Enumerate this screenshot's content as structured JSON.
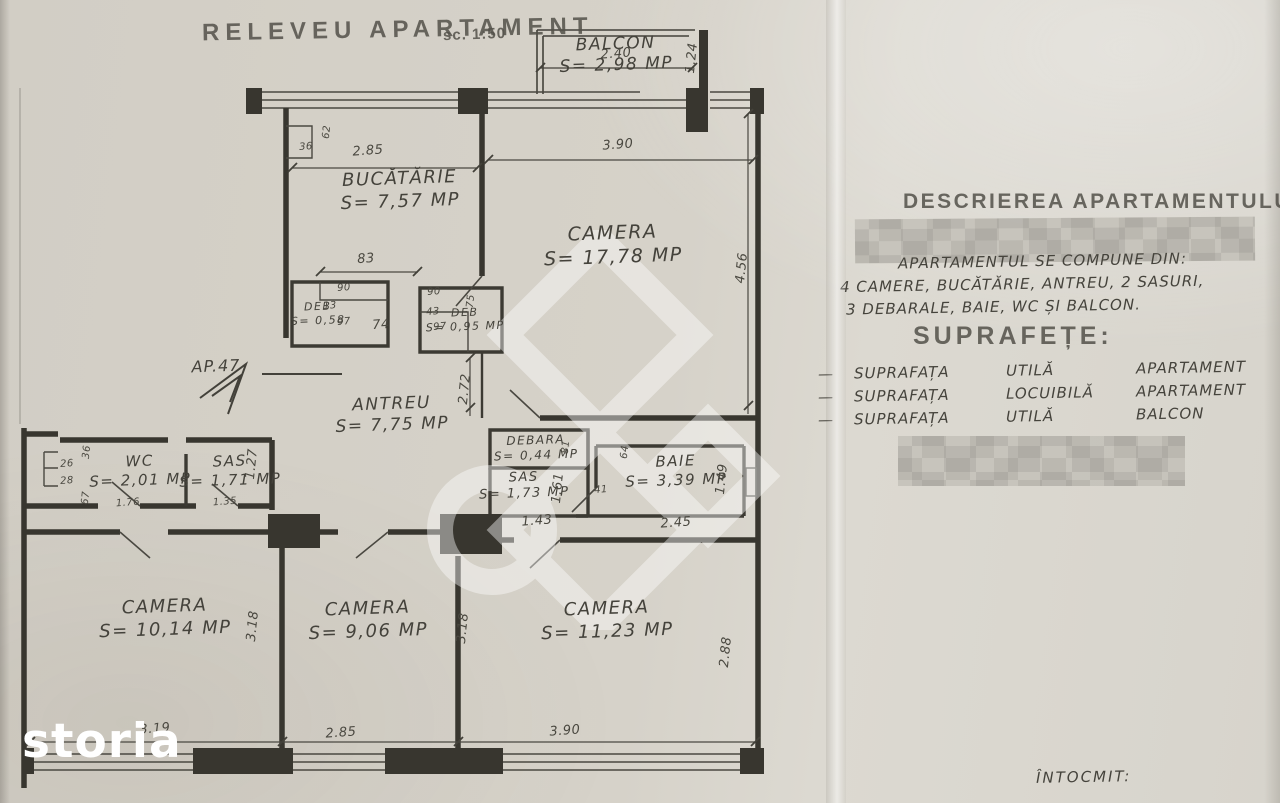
{
  "title": {
    "main": "RELEVEU APARTAMENT",
    "scale": "sc. 1:50"
  },
  "watermark": {
    "brand": "storia"
  },
  "plan": {
    "arrow_label": "AP.47",
    "rooms": {
      "balcon": {
        "name": "BALCON",
        "area": "S= 2,98 MP"
      },
      "bucatarie": {
        "name": "BUCĂTĂRIE",
        "area": "S= 7,57 MP"
      },
      "camera_mare": {
        "name": "CAMERA",
        "area": "S= 17,78 MP"
      },
      "antreu": {
        "name": "ANTREU",
        "area": "S= 7,75 MP"
      },
      "deb1": {
        "name": "DEB",
        "area": "S= 0,58"
      },
      "deb2": {
        "name": "DEB",
        "area": "S= 0,95 MP"
      },
      "wc": {
        "name": "WC",
        "area": "S= 2,01 MP"
      },
      "sas1": {
        "name": "SAS",
        "area": "S= 1,71 MP"
      },
      "debara": {
        "name": "DEBARA",
        "area": "S= 0,44 MP"
      },
      "sas2": {
        "name": "SAS",
        "area": "S= 1,73 MP"
      },
      "baie": {
        "name": "BAIE",
        "area": "S= 3,39 MP"
      },
      "camera1": {
        "name": "CAMERA",
        "area": "S= 10,14 MP"
      },
      "camera2": {
        "name": "CAMERA",
        "area": "S= 9,06 MP"
      },
      "camera3": {
        "name": "CAMERA",
        "area": "S= 11,23 MP"
      }
    },
    "dims": {
      "balcon_w": "2.40",
      "balcon_h": "1.24",
      "bucatarie_w": "2.85",
      "bucatarie_jog_h": "62",
      "bucatarie_jog_w": "36",
      "camera_mare_w": "3.90",
      "camera_mare_h": "4.56",
      "deb_span": "83",
      "deb1_w": "90",
      "deb1_step": "13",
      "deb1_d": "97",
      "corridor_w": "74",
      "deb2_w": "90",
      "deb2_step": "43",
      "deb2_d": "97",
      "deb2_h": "75",
      "antreu_h": "2.72",
      "wc_jog": "36",
      "wc_s26": "26",
      "wc_s28": "28",
      "wc_s67": "67",
      "wc_w": "1.76",
      "sas1_w": "1.35",
      "sas1_h": "1.27",
      "debara_h": "81",
      "sas2_h": "1.61",
      "baie_nisa": "64",
      "baie_door": "41",
      "sas2_w": "1.43",
      "baie_w": "2.45",
      "baie_h": "1.49",
      "camera1_h": "3.18",
      "camera2_h": "3.18",
      "camera3_h": "2.88",
      "camera1_w": "3.19",
      "camera2_w": "2.85",
      "camera3_w": "3.90"
    }
  },
  "description": {
    "heading": "DESCRIEREA APARTAMENTULUI",
    "compose_intro": "APARTAMENTUL SE COMPUNE DIN:",
    "compose_line2": "4 CAMERE, BUCĂTĂRIE, ANTREU, 2 SASURI,",
    "compose_line3": "3 DEBARALE, BAIE, WC ȘI BALCON.",
    "suprafete_heading": "SUPRAFEȚE:",
    "row_dash": "—",
    "rows": [
      {
        "c1": "SUPRAFAȚA",
        "c2": "UTILĂ",
        "c3": "APARTAMENT",
        "sep": ":",
        "value": "73,97 MP"
      },
      {
        "c1": "SUPRAFAȚA",
        "c2": "LOCUIBILĂ",
        "c3": "APARTAMENT",
        "sep": ":",
        "value": "48,21 MP"
      },
      {
        "c1": "SUPRAFAȚA",
        "c2": "UTILĂ",
        "c3": "BALCON",
        "sep": ":",
        "value": "2,98 MP"
      }
    ],
    "intocmit": "ÎNTOCMIT:"
  }
}
